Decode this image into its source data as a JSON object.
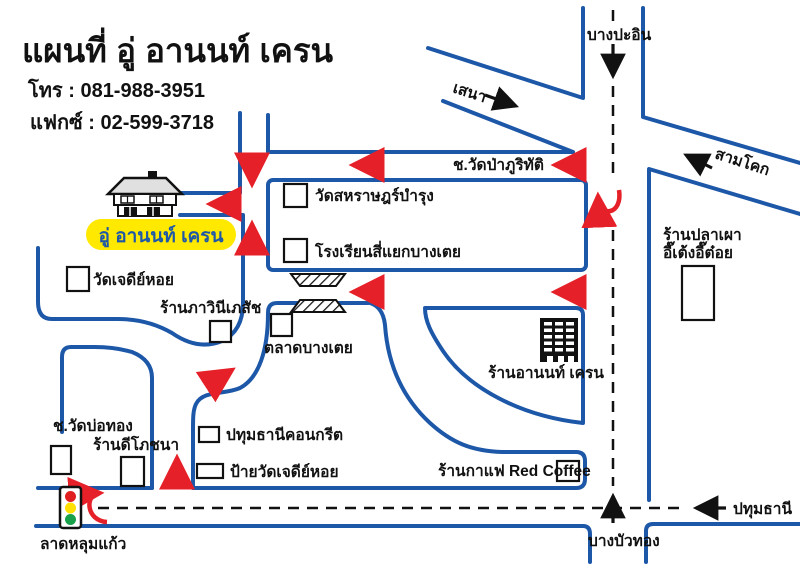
{
  "colors": {
    "road_blue": "#1d57a8",
    "arrow_red": "#e62028",
    "highlight_yellow": "#ffe900",
    "text_black": "#111111",
    "traffic_red": "#e02020",
    "traffic_yellow": "#ffe000",
    "traffic_green": "#18a04a"
  },
  "header": {
    "title": "แผนที่ อู่ อานนท์ เครน",
    "phone": "โทร : 081-988-3951",
    "fax": "แฟกซ์ : 02-599-3718"
  },
  "destination_label": "อู่ อานนท์ เครน",
  "map": {
    "directions": {
      "top": "บางปะอิน",
      "top_left": "เสนา",
      "top_right": "สามโคก",
      "bottom_left": "ลาดหลุมแก้ว",
      "bottom_right": "ปทุมธานี",
      "bottom": "บางบัวทอง"
    },
    "streets": {
      "wat_pa_soi": "ช.วัดป่าภูริทัติ",
      "wat_bothong_soi": "ช.วัดบ่อทอง"
    },
    "landmarks": {
      "temple_saharat": "วัดสหราษฎร์บำรุง",
      "school": "โรงเรียนสี่แยกบางเตย",
      "grilled_fish_line1": "ร้านปลาเผา",
      "grilled_fish_line2": "อี๊เต้งอี๊ต๋อย",
      "temple_jedi": "วัดเจดีย์หอย",
      "pharmacy": "ร้านภาวินีเภสัช",
      "market": "ตลาดบางเตย",
      "crane_shop": "ร้านอานนท์ เครน",
      "restaurant_dee": "ร้านดีโภชนา",
      "concrete": "ปทุมธานีคอนกรีต",
      "temple_sign": "ป้ายวัดเจดีย์หอย",
      "coffee": "ร้านกาแฟ Red Coffee"
    }
  }
}
